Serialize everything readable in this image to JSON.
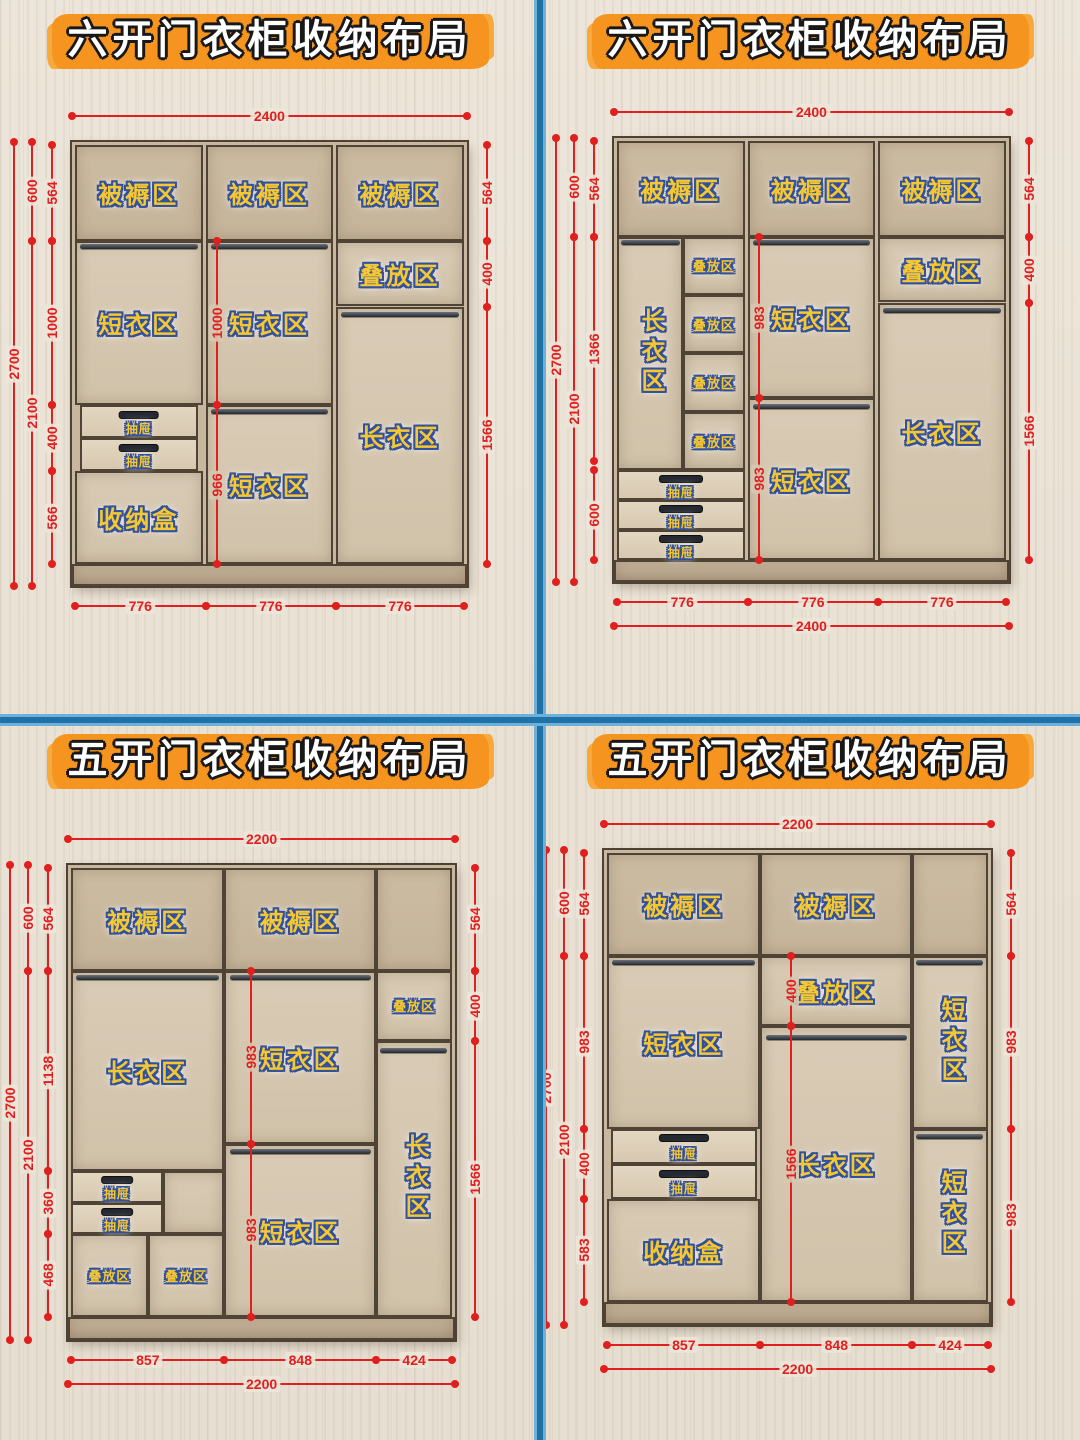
{
  "colors": {
    "divider_blue": "#1e72a7",
    "title_orange": "#f5941e",
    "dimension_red": "#e01f1f",
    "zone_label_yellow": "#f4c733",
    "zone_label_outline_blue": "#31519e",
    "wood_frame": "#c7b79e",
    "wood_interior": "#d9cbb5"
  },
  "quadrants": [
    {
      "title": "六开门衣柜收纳布局",
      "cabinet": {
        "w": 2400,
        "h": 2700,
        "px": {
          "x": 72,
          "y": 142,
          "scale": 0.1645
        }
      },
      "cells": [
        {
          "x": 18,
          "y": 18,
          "w": 776,
          "h": 582,
          "label": "被褥区",
          "variant": "top"
        },
        {
          "x": 812,
          "y": 18,
          "w": 776,
          "h": 582,
          "label": "被褥区",
          "variant": "top"
        },
        {
          "x": 1606,
          "y": 18,
          "w": 776,
          "h": 582,
          "label": "被褥区",
          "variant": "top"
        },
        {
          "x": 18,
          "y": 600,
          "w": 776,
          "h": 1000,
          "label": "短衣区"
        },
        {
          "x": 18,
          "y": 2000,
          "w": 776,
          "h": 566,
          "label": "收纳盒"
        },
        {
          "x": 812,
          "y": 600,
          "w": 776,
          "h": 1000,
          "label": "短衣区"
        },
        {
          "x": 812,
          "y": 1600,
          "w": 776,
          "h": 966,
          "label": "短衣区"
        },
        {
          "x": 1606,
          "y": 600,
          "w": 776,
          "h": 400,
          "label": "叠放区"
        },
        {
          "x": 1606,
          "y": 1000,
          "w": 776,
          "h": 1566,
          "label": "长衣区"
        },
        {
          "x": 0,
          "y": 2566,
          "w": 2400,
          "h": 134,
          "variant": "base"
        }
      ],
      "drawers": [
        {
          "x": 48,
          "y": 1600,
          "w": 716,
          "h": 200,
          "label": "抽屉"
        },
        {
          "x": 48,
          "y": 1800,
          "w": 716,
          "h": 200,
          "label": "抽屉"
        }
      ],
      "rods": [
        {
          "x": 48,
          "y": 622,
          "w": 716
        },
        {
          "x": 842,
          "y": 622,
          "w": 716
        },
        {
          "x": 842,
          "y": 1622,
          "w": 716
        },
        {
          "x": 1636,
          "y": 1032,
          "w": 716
        }
      ],
      "dims": {
        "top": [
          {
            "off": -26,
            "from": 0,
            "to": 2400,
            "label": "2400"
          }
        ],
        "left": [
          {
            "off": -58,
            "from": 0,
            "to": 2700,
            "label": "2700"
          },
          {
            "off": -40,
            "from": 0,
            "to": 600,
            "label": "600"
          },
          {
            "off": -40,
            "from": 600,
            "to": 2700,
            "label": "2100"
          },
          {
            "off": -20,
            "from": 18,
            "to": 600,
            "label": "564"
          },
          {
            "off": -20,
            "from": 600,
            "to": 1600,
            "label": "1000"
          },
          {
            "off": -20,
            "from": 1600,
            "to": 2000,
            "label": "400"
          },
          {
            "off": -20,
            "from": 2000,
            "to": 2566,
            "label": "566"
          }
        ],
        "right": [
          {
            "off": 20,
            "from": 18,
            "to": 600,
            "label": "564"
          },
          {
            "off": 20,
            "from": 600,
            "to": 1000,
            "label": "400"
          },
          {
            "off": 20,
            "from": 1000,
            "to": 2566,
            "label": "1566"
          }
        ],
        "inner": [
          {
            "x": 880,
            "from": 600,
            "to": 1600,
            "label": "1000"
          },
          {
            "x": 880,
            "from": 1600,
            "to": 2566,
            "label": "966"
          }
        ],
        "bottom": [
          {
            "off": 20,
            "from": 18,
            "to": 812,
            "label": "776"
          },
          {
            "off": 20,
            "from": 812,
            "to": 1606,
            "label": "776"
          },
          {
            "off": 20,
            "from": 1606,
            "to": 2382,
            "label": "776"
          }
        ]
      }
    },
    {
      "title": "六开门衣柜收纳布局",
      "cabinet": {
        "w": 2400,
        "h": 2700,
        "px": {
          "x": 74,
          "y": 138,
          "scale": 0.1645
        }
      },
      "cells": [
        {
          "x": 18,
          "y": 18,
          "w": 776,
          "h": 582,
          "label": "被褥区",
          "variant": "top"
        },
        {
          "x": 812,
          "y": 18,
          "w": 776,
          "h": 582,
          "label": "被褥区",
          "variant": "top"
        },
        {
          "x": 1606,
          "y": 18,
          "w": 776,
          "h": 582,
          "label": "被褥区",
          "variant": "top"
        },
        {
          "x": 18,
          "y": 600,
          "w": 402,
          "h": 1420,
          "label": "长衣区",
          "vertical": true
        },
        {
          "x": 420,
          "y": 600,
          "w": 374,
          "h": 355,
          "label": "叠放区",
          "small": true
        },
        {
          "x": 420,
          "y": 955,
          "w": 374,
          "h": 355,
          "label": "叠放区",
          "small": true
        },
        {
          "x": 420,
          "y": 1310,
          "w": 374,
          "h": 355,
          "label": "叠放区",
          "small": true
        },
        {
          "x": 420,
          "y": 1665,
          "w": 374,
          "h": 355,
          "label": "叠放区",
          "small": true
        },
        {
          "x": 812,
          "y": 600,
          "w": 776,
          "h": 983,
          "label": "短衣区"
        },
        {
          "x": 812,
          "y": 1583,
          "w": 776,
          "h": 983,
          "label": "短衣区"
        },
        {
          "x": 1606,
          "y": 600,
          "w": 776,
          "h": 400,
          "label": "叠放区"
        },
        {
          "x": 1606,
          "y": 1000,
          "w": 776,
          "h": 1566,
          "label": "长衣区"
        },
        {
          "x": 0,
          "y": 2566,
          "w": 2400,
          "h": 134,
          "variant": "base"
        }
      ],
      "drawers": [
        {
          "x": 18,
          "y": 2020,
          "w": 776,
          "h": 182,
          "label": "抽屉"
        },
        {
          "x": 18,
          "y": 2202,
          "w": 776,
          "h": 182,
          "label": "抽屉"
        },
        {
          "x": 18,
          "y": 2384,
          "w": 776,
          "h": 182,
          "label": "抽屉"
        }
      ],
      "rods": [
        {
          "x": 40,
          "y": 622,
          "w": 360
        },
        {
          "x": 842,
          "y": 622,
          "w": 716
        },
        {
          "x": 842,
          "y": 1615,
          "w": 716
        },
        {
          "x": 1636,
          "y": 1032,
          "w": 716
        }
      ],
      "dims": {
        "top": [
          {
            "off": -26,
            "from": 0,
            "to": 2400,
            "label": "2400"
          }
        ],
        "left": [
          {
            "off": -58,
            "from": 0,
            "to": 2700,
            "label": "2700"
          },
          {
            "off": -40,
            "from": 0,
            "to": 600,
            "label": "600"
          },
          {
            "off": -40,
            "from": 600,
            "to": 2700,
            "label": "2100"
          },
          {
            "off": -20,
            "from": 18,
            "to": 600,
            "label": "564"
          },
          {
            "off": -20,
            "from": 600,
            "to": 1966,
            "label": "1366"
          },
          {
            "off": -20,
            "from": 2020,
            "to": 2566,
            "label": "600"
          }
        ],
        "right": [
          {
            "off": 20,
            "from": 18,
            "to": 600,
            "label": "564"
          },
          {
            "off": 20,
            "from": 600,
            "to": 1000,
            "label": "400"
          },
          {
            "off": 20,
            "from": 1000,
            "to": 2566,
            "label": "1566"
          }
        ],
        "inner": [
          {
            "x": 880,
            "from": 600,
            "to": 1583,
            "label": "983"
          },
          {
            "x": 880,
            "from": 1583,
            "to": 2566,
            "label": "983"
          }
        ],
        "bottom": [
          {
            "off": 20,
            "from": 18,
            "to": 812,
            "label": "776"
          },
          {
            "off": 20,
            "from": 812,
            "to": 1606,
            "label": "776"
          },
          {
            "off": 20,
            "from": 1606,
            "to": 2382,
            "label": "776"
          },
          {
            "off": 44,
            "from": 0,
            "to": 2400,
            "label": "2400"
          }
        ]
      }
    },
    {
      "title": "五开门衣柜收纳布局",
      "cabinet": {
        "w": 2200,
        "h": 2700,
        "px": {
          "x": 68,
          "y": 145,
          "scale": 0.176
        }
      },
      "cells": [
        {
          "x": 18,
          "y": 18,
          "w": 871,
          "h": 582,
          "label": "被褥区",
          "variant": "top"
        },
        {
          "x": 889,
          "y": 18,
          "w": 862,
          "h": 582,
          "label": "被褥区",
          "variant": "top"
        },
        {
          "x": 1751,
          "y": 18,
          "w": 431,
          "h": 582,
          "variant": "top"
        },
        {
          "x": 18,
          "y": 600,
          "w": 871,
          "h": 1138,
          "label": "长衣区"
        },
        {
          "x": 538,
          "y": 1738,
          "w": 351,
          "h": 360
        },
        {
          "x": 18,
          "y": 2098,
          "w": 435,
          "h": 468,
          "label": "叠放区",
          "small": true
        },
        {
          "x": 453,
          "y": 2098,
          "w": 436,
          "h": 468,
          "label": "叠放区",
          "small": true
        },
        {
          "x": 889,
          "y": 600,
          "w": 862,
          "h": 983,
          "label": "短衣区"
        },
        {
          "x": 889,
          "y": 1583,
          "w": 862,
          "h": 983,
          "label": "短衣区"
        },
        {
          "x": 1751,
          "y": 600,
          "w": 431,
          "h": 400,
          "label": "叠放区",
          "small": true
        },
        {
          "x": 1751,
          "y": 1000,
          "w": 431,
          "h": 1566,
          "label": "长衣区",
          "vertical": true
        },
        {
          "x": 0,
          "y": 2566,
          "w": 2200,
          "h": 134,
          "variant": "base"
        }
      ],
      "drawers": [
        {
          "x": 18,
          "y": 1738,
          "w": 520,
          "h": 180,
          "label": "抽屉"
        },
        {
          "x": 18,
          "y": 1918,
          "w": 520,
          "h": 180,
          "label": "抽屉"
        }
      ],
      "rods": [
        {
          "x": 48,
          "y": 624,
          "w": 810
        },
        {
          "x": 919,
          "y": 624,
          "w": 800
        },
        {
          "x": 919,
          "y": 1615,
          "w": 800
        },
        {
          "x": 1775,
          "y": 1042,
          "w": 380
        }
      ],
      "dims": {
        "top": [
          {
            "off": -26,
            "from": 0,
            "to": 2200,
            "label": "2200"
          }
        ],
        "left": [
          {
            "off": -58,
            "from": 0,
            "to": 2700,
            "label": "2700"
          },
          {
            "off": -40,
            "from": 0,
            "to": 600,
            "label": "600"
          },
          {
            "off": -40,
            "from": 600,
            "to": 2700,
            "label": "2100"
          },
          {
            "off": -20,
            "from": 18,
            "to": 600,
            "label": "564"
          },
          {
            "off": -20,
            "from": 600,
            "to": 1738,
            "label": "1138"
          },
          {
            "off": -20,
            "from": 1738,
            "to": 2098,
            "label": "360"
          },
          {
            "off": -20,
            "from": 2098,
            "to": 2566,
            "label": "468"
          }
        ],
        "right": [
          {
            "off": 20,
            "from": 18,
            "to": 600,
            "label": "564"
          },
          {
            "off": 20,
            "from": 600,
            "to": 1000,
            "label": "400"
          },
          {
            "off": 20,
            "from": 1000,
            "to": 2566,
            "label": "1566"
          }
        ],
        "inner": [
          {
            "x": 1040,
            "from": 600,
            "to": 1583,
            "label": "983"
          },
          {
            "x": 1040,
            "from": 1583,
            "to": 2566,
            "label": "983"
          }
        ],
        "bottom": [
          {
            "off": 20,
            "from": 18,
            "to": 889,
            "label": "857"
          },
          {
            "off": 20,
            "from": 889,
            "to": 1751,
            "label": "848"
          },
          {
            "off": 20,
            "from": 1751,
            "to": 2182,
            "label": "424"
          },
          {
            "off": 44,
            "from": 0,
            "to": 2200,
            "label": "2200"
          }
        ]
      }
    },
    {
      "title": "五开门衣柜收纳布局",
      "cabinet": {
        "w": 2200,
        "h": 2700,
        "px": {
          "x": 64,
          "y": 130,
          "scale": 0.176
        }
      },
      "cells": [
        {
          "x": 18,
          "y": 18,
          "w": 871,
          "h": 582,
          "label": "被褥区",
          "variant": "top"
        },
        {
          "x": 889,
          "y": 18,
          "w": 862,
          "h": 582,
          "label": "被褥区",
          "variant": "top"
        },
        {
          "x": 1751,
          "y": 18,
          "w": 431,
          "h": 582,
          "variant": "top"
        },
        {
          "x": 18,
          "y": 600,
          "w": 871,
          "h": 983,
          "label": "短衣区"
        },
        {
          "x": 18,
          "y": 1983,
          "w": 871,
          "h": 583,
          "label": "收纳盒"
        },
        {
          "x": 889,
          "y": 600,
          "w": 862,
          "h": 400,
          "label": "叠放区"
        },
        {
          "x": 889,
          "y": 1000,
          "w": 862,
          "h": 1566,
          "label": "长衣区"
        },
        {
          "x": 1751,
          "y": 600,
          "w": 431,
          "h": 983,
          "label": "短衣区",
          "vertical": true
        },
        {
          "x": 1751,
          "y": 1583,
          "w": 431,
          "h": 983,
          "label": "短衣区",
          "vertical": true
        },
        {
          "x": 0,
          "y": 2566,
          "w": 2200,
          "h": 134,
          "variant": "base"
        }
      ],
      "drawers": [
        {
          "x": 40,
          "y": 1583,
          "w": 827,
          "h": 200,
          "label": "抽屉"
        },
        {
          "x": 40,
          "y": 1783,
          "w": 827,
          "h": 200,
          "label": "抽屉"
        }
      ],
      "rods": [
        {
          "x": 48,
          "y": 624,
          "w": 810
        },
        {
          "x": 919,
          "y": 1052,
          "w": 800
        },
        {
          "x": 1775,
          "y": 624,
          "w": 380
        },
        {
          "x": 1775,
          "y": 1615,
          "w": 380
        }
      ],
      "dims": {
        "top": [
          {
            "off": -26,
            "from": 0,
            "to": 2200,
            "label": "2200"
          }
        ],
        "left": [
          {
            "off": -58,
            "from": 0,
            "to": 2700,
            "label": "2700"
          },
          {
            "off": -40,
            "from": 0,
            "to": 600,
            "label": "600"
          },
          {
            "off": -40,
            "from": 600,
            "to": 2700,
            "label": "2100"
          },
          {
            "off": -20,
            "from": 18,
            "to": 600,
            "label": "564"
          },
          {
            "off": -20,
            "from": 600,
            "to": 1583,
            "label": "983"
          },
          {
            "off": -20,
            "from": 1583,
            "to": 1983,
            "label": "400"
          },
          {
            "off": -20,
            "from": 1983,
            "to": 2566,
            "label": "583"
          }
        ],
        "right": [
          {
            "off": 20,
            "from": 18,
            "to": 600,
            "label": "564"
          },
          {
            "off": 20,
            "from": 600,
            "to": 1583,
            "label": "983"
          },
          {
            "off": 20,
            "from": 1583,
            "to": 2566,
            "label": "983"
          }
        ],
        "inner": [
          {
            "x": 1060,
            "from": 600,
            "to": 1000,
            "label": "400"
          },
          {
            "x": 1060,
            "from": 1000,
            "to": 2566,
            "label": "1566"
          }
        ],
        "bottom": [
          {
            "off": 20,
            "from": 18,
            "to": 889,
            "label": "857"
          },
          {
            "off": 20,
            "from": 889,
            "to": 1751,
            "label": "848"
          },
          {
            "off": 20,
            "from": 1751,
            "to": 2182,
            "label": "424"
          },
          {
            "off": 44,
            "from": 0,
            "to": 2200,
            "label": "2200"
          }
        ]
      }
    }
  ]
}
